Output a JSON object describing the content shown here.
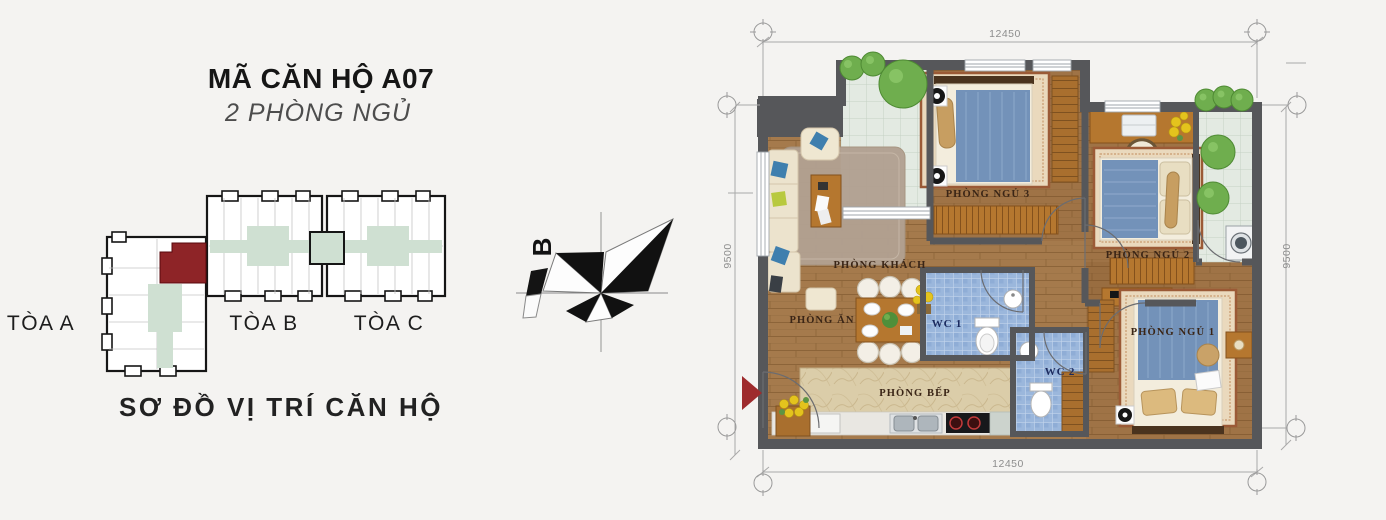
{
  "header": {
    "title": "MÃ CĂN HỘ A07",
    "subtitle": "2 PHÒNG NGỦ"
  },
  "location_diagram": {
    "caption": "SƠ ĐỒ VỊ TRÍ CĂN HỘ",
    "buildings": {
      "a": "TÒA A",
      "b": "TÒA B",
      "c": "TÒA C"
    },
    "highlight_color": "#8e2427",
    "core_color": "#cfe0d2"
  },
  "compass": {
    "north_label": "B"
  },
  "floor_plan": {
    "room_labels": {
      "living": "PHÒNG KHÁCH",
      "dining": "PHÒNG ĂN",
      "kitchen": "PHÒNG BẾP",
      "wc1": "WC 1",
      "wc2": "WC 2",
      "bedroom1": "PHÒNG NGỦ 1",
      "bedroom2": "PHÒNG NGỦ 2",
      "bedroom3": "PHÒNG NGỦ 3"
    },
    "dimensions": {
      "top": "12450",
      "bottom": "12450",
      "left": "9500",
      "right": "9500"
    },
    "colors": {
      "wall": "#56575a",
      "wood_floor": "#a5794b",
      "balcony_tile": "#e3eae2",
      "wc_tile": "#9bb7dc",
      "counter": "#dbcda9",
      "bed_blue": "#7392b9",
      "entry_arrow_red": "#9e2b2d"
    }
  }
}
